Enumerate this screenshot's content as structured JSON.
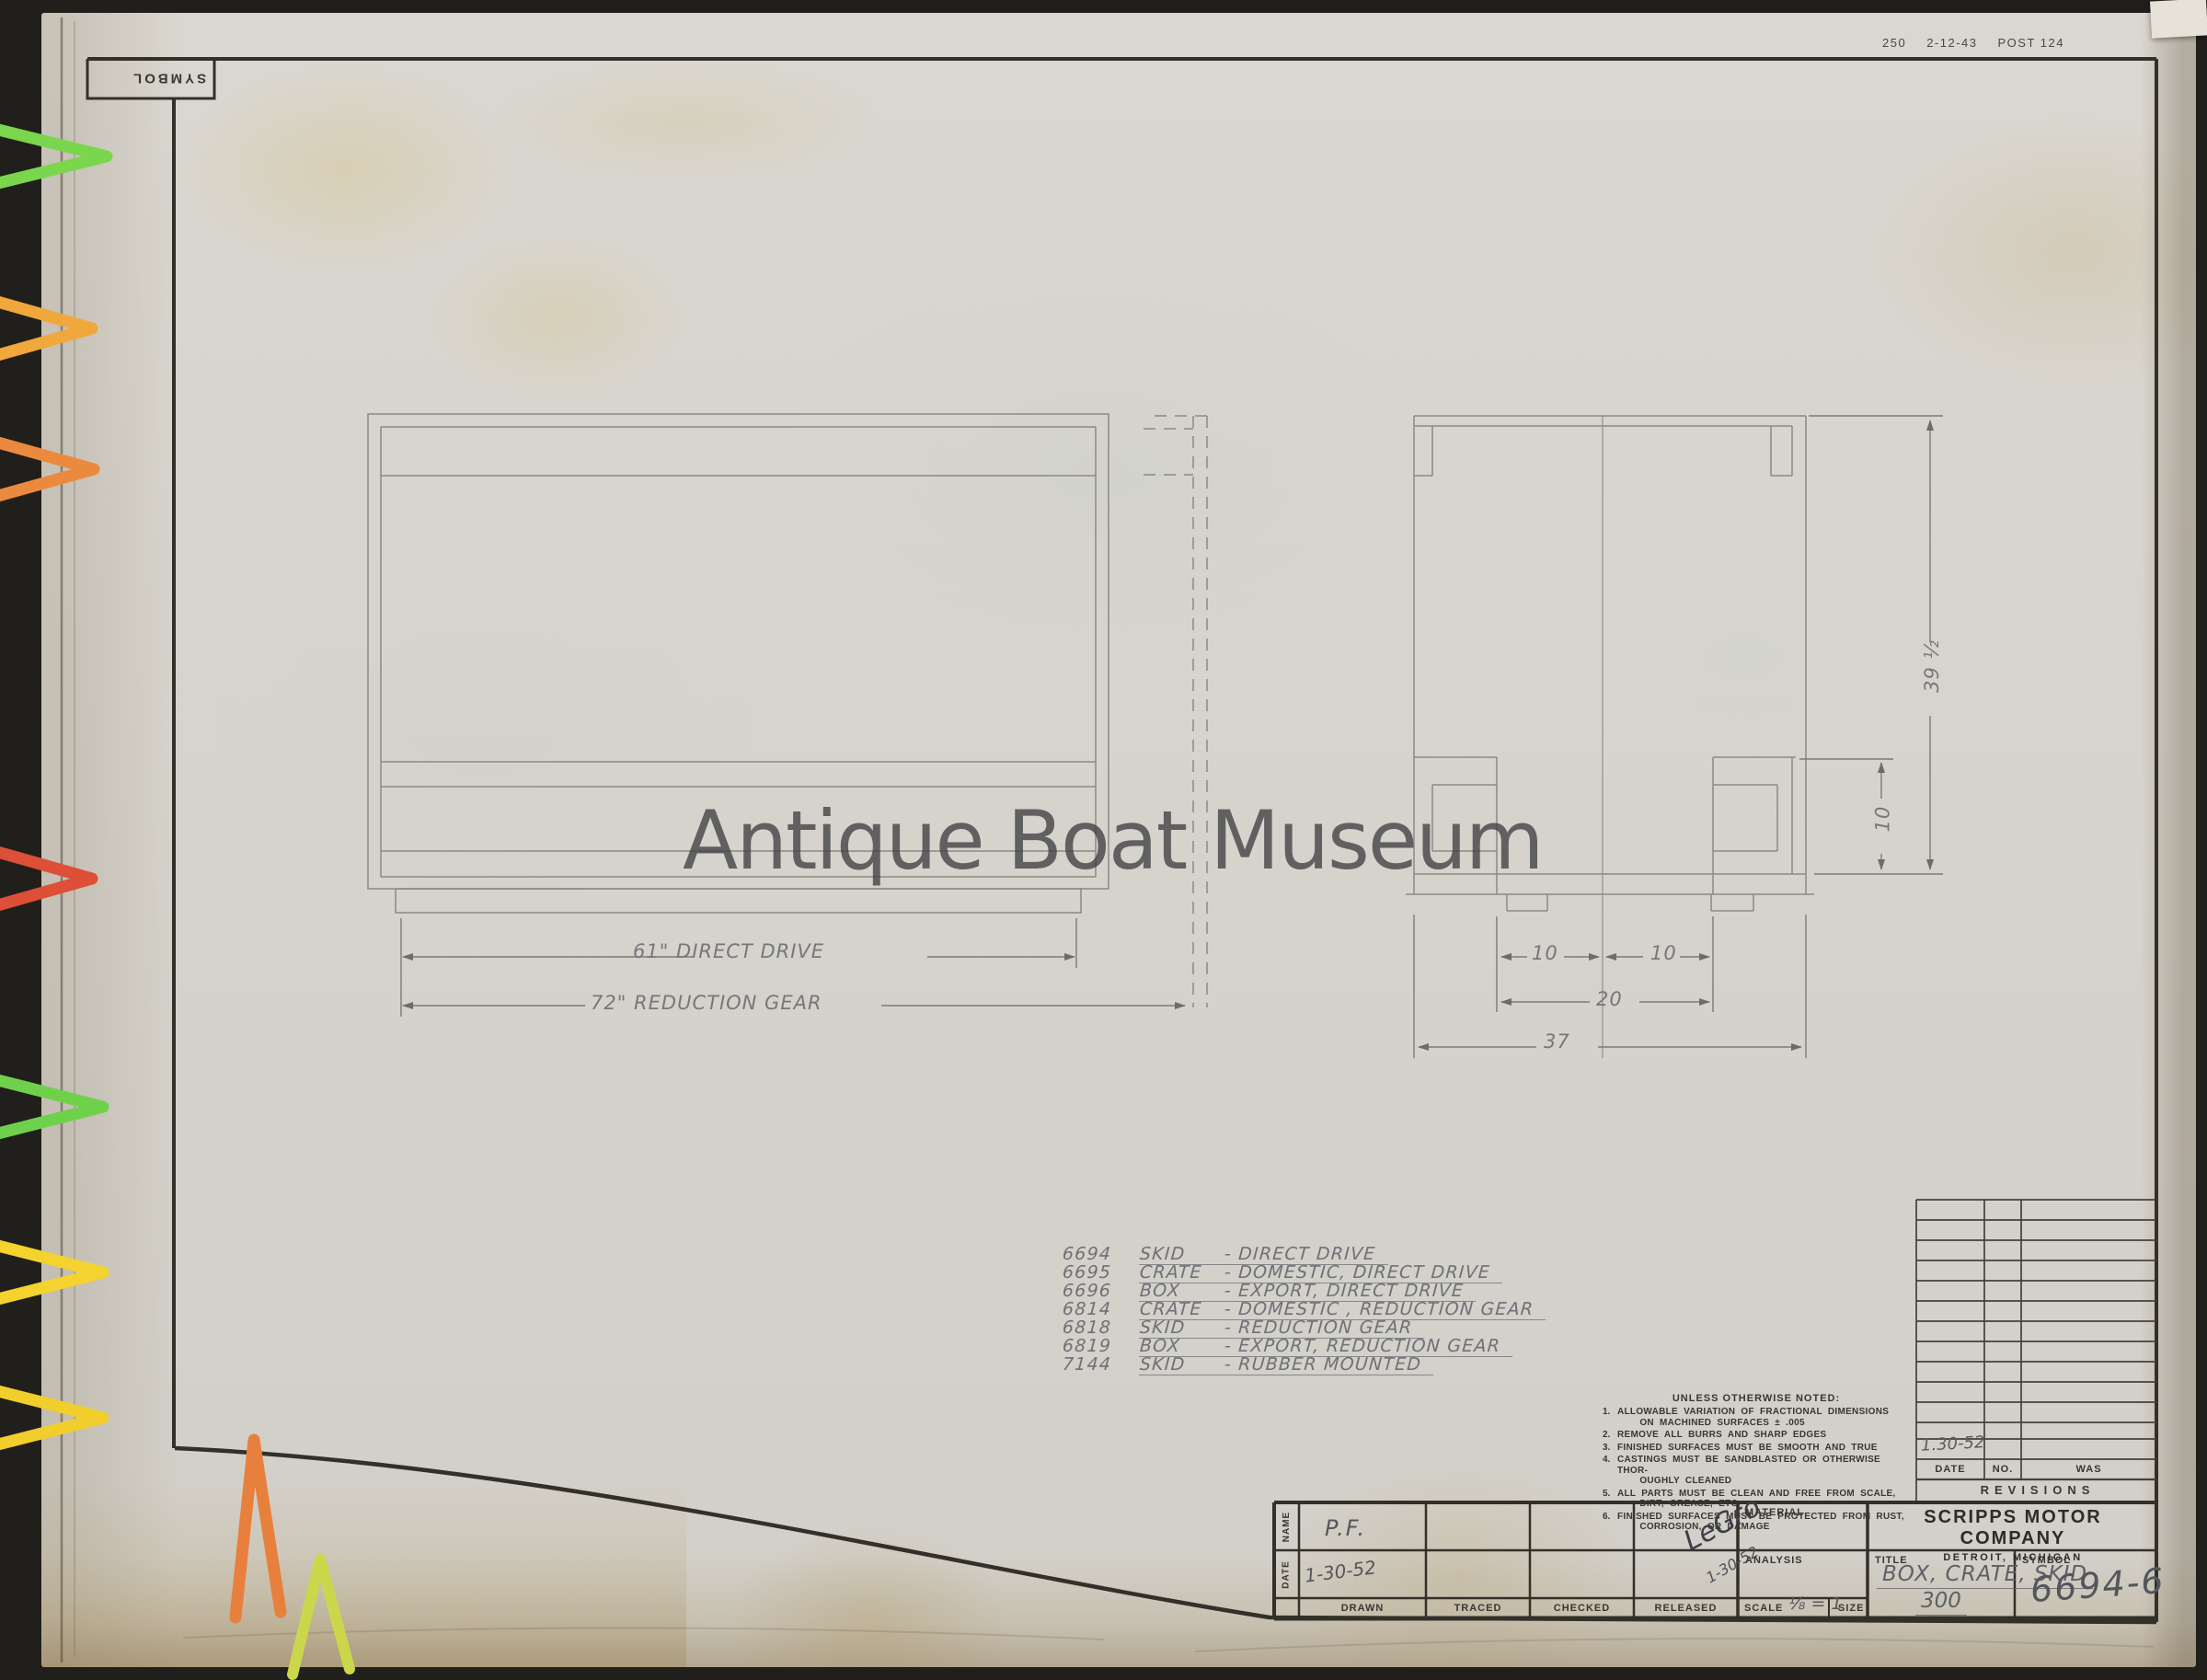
{
  "stamp": {
    "code": "250",
    "date": "2-12-43",
    "post": "POST 124"
  },
  "back_label": "SYMBOL",
  "watermark": "Antique Boat Museum",
  "views": {
    "dim_direct": "61\" DIRECT DRIVE",
    "dim_reduction": "72\" REDUCTION GEAR",
    "dim_ten_left": "10",
    "dim_ten_right": "10",
    "dim_twenty": "20",
    "dim_thirty_seven": "37",
    "dim_height": "39 ½",
    "dim_block": "10"
  },
  "parts_list": [
    {
      "number": "6694",
      "type": "SKID",
      "desc": "- DIRECT DRIVE"
    },
    {
      "number": "6695",
      "type": "CRATE",
      "desc": "- DOMESTIC, DIRECT DRIVE"
    },
    {
      "number": "6696",
      "type": "BOX",
      "desc": "- EXPORT, DIRECT DRIVE"
    },
    {
      "number": "6814",
      "type": "CRATE",
      "desc": "- DOMESTIC , REDUCTION GEAR"
    },
    {
      "number": "6818",
      "type": "SKID",
      "desc": "- REDUCTION GEAR"
    },
    {
      "number": "6819",
      "type": "BOX",
      "desc": "- EXPORT, REDUCTION GEAR"
    },
    {
      "number": "7144",
      "type": "SKID",
      "desc": "- RUBBER MOUNTED"
    }
  ],
  "notes": {
    "title": "UNLESS OTHERWISE NOTED:",
    "items": [
      {
        "no": "1.",
        "text": "ALLOWABLE VARIATION OF FRACTIONAL DIMENSIONS\n    ON MACHINED SURFACES ± .005"
      },
      {
        "no": "2.",
        "text": "REMOVE ALL BURRS AND SHARP EDGES"
      },
      {
        "no": "3.",
        "text": "FINISHED SURFACES MUST BE SMOOTH AND TRUE"
      },
      {
        "no": "4.",
        "text": "CASTINGS MUST BE SANDBLASTED OR OTHERWISE THOR-\n    OUGHLY CLEANED"
      },
      {
        "no": "5.",
        "text": "ALL PARTS MUST BE CLEAN AND FREE FROM SCALE,\n    DIRT, GREASE, ETC."
      },
      {
        "no": "6.",
        "text": "FINISHED SURFACES MUST BE PROTECTED FROM RUST,\n    CORROSION, OR DAMAGE"
      }
    ]
  },
  "revisions": {
    "entry_date": "1.30-52",
    "date_label": "DATE",
    "no_label": "NO.",
    "was_label": "WAS",
    "title": "REVISIONS"
  },
  "title_block": {
    "name_label": "NAME",
    "date_label": "DATE",
    "drawn_label": "DRAWN",
    "traced_label": "TRACED",
    "checked_label": "CHECKED",
    "released_label": "RELEASED",
    "material_label": "MATERIAL",
    "analysis_label": "ANALYSIS",
    "scale_label": "SCALE",
    "size_label": "SIZE",
    "drawn_name": "P.F.",
    "drawn_date": "1-30-52",
    "released_signature": "LeGro",
    "released_date": "1-30-52",
    "scale_value": "⅛ = 1",
    "company_name": "SCRIPPS MOTOR COMPANY",
    "company_location": "DETROIT, MICHIGAN",
    "title_label": "TITLE",
    "drawing_title": "BOX, CRATE, SKID",
    "drawing_title_sub": "300",
    "symbol_label": "SYMBOL",
    "symbol_value": "6694-6"
  },
  "colors": {
    "paper": "#d7d4cd",
    "backdrop": "#211f1b",
    "pencil": "#8d8a82",
    "ink": "#332f29",
    "clip_green": "#79d64d",
    "clip_amber": "#f0a73c",
    "clip_orange": "#eb8a3e",
    "clip_red": "#dd4f36",
    "clip_yellow": "#f4d32f",
    "clip_yellow_green": "#cbd74b"
  }
}
